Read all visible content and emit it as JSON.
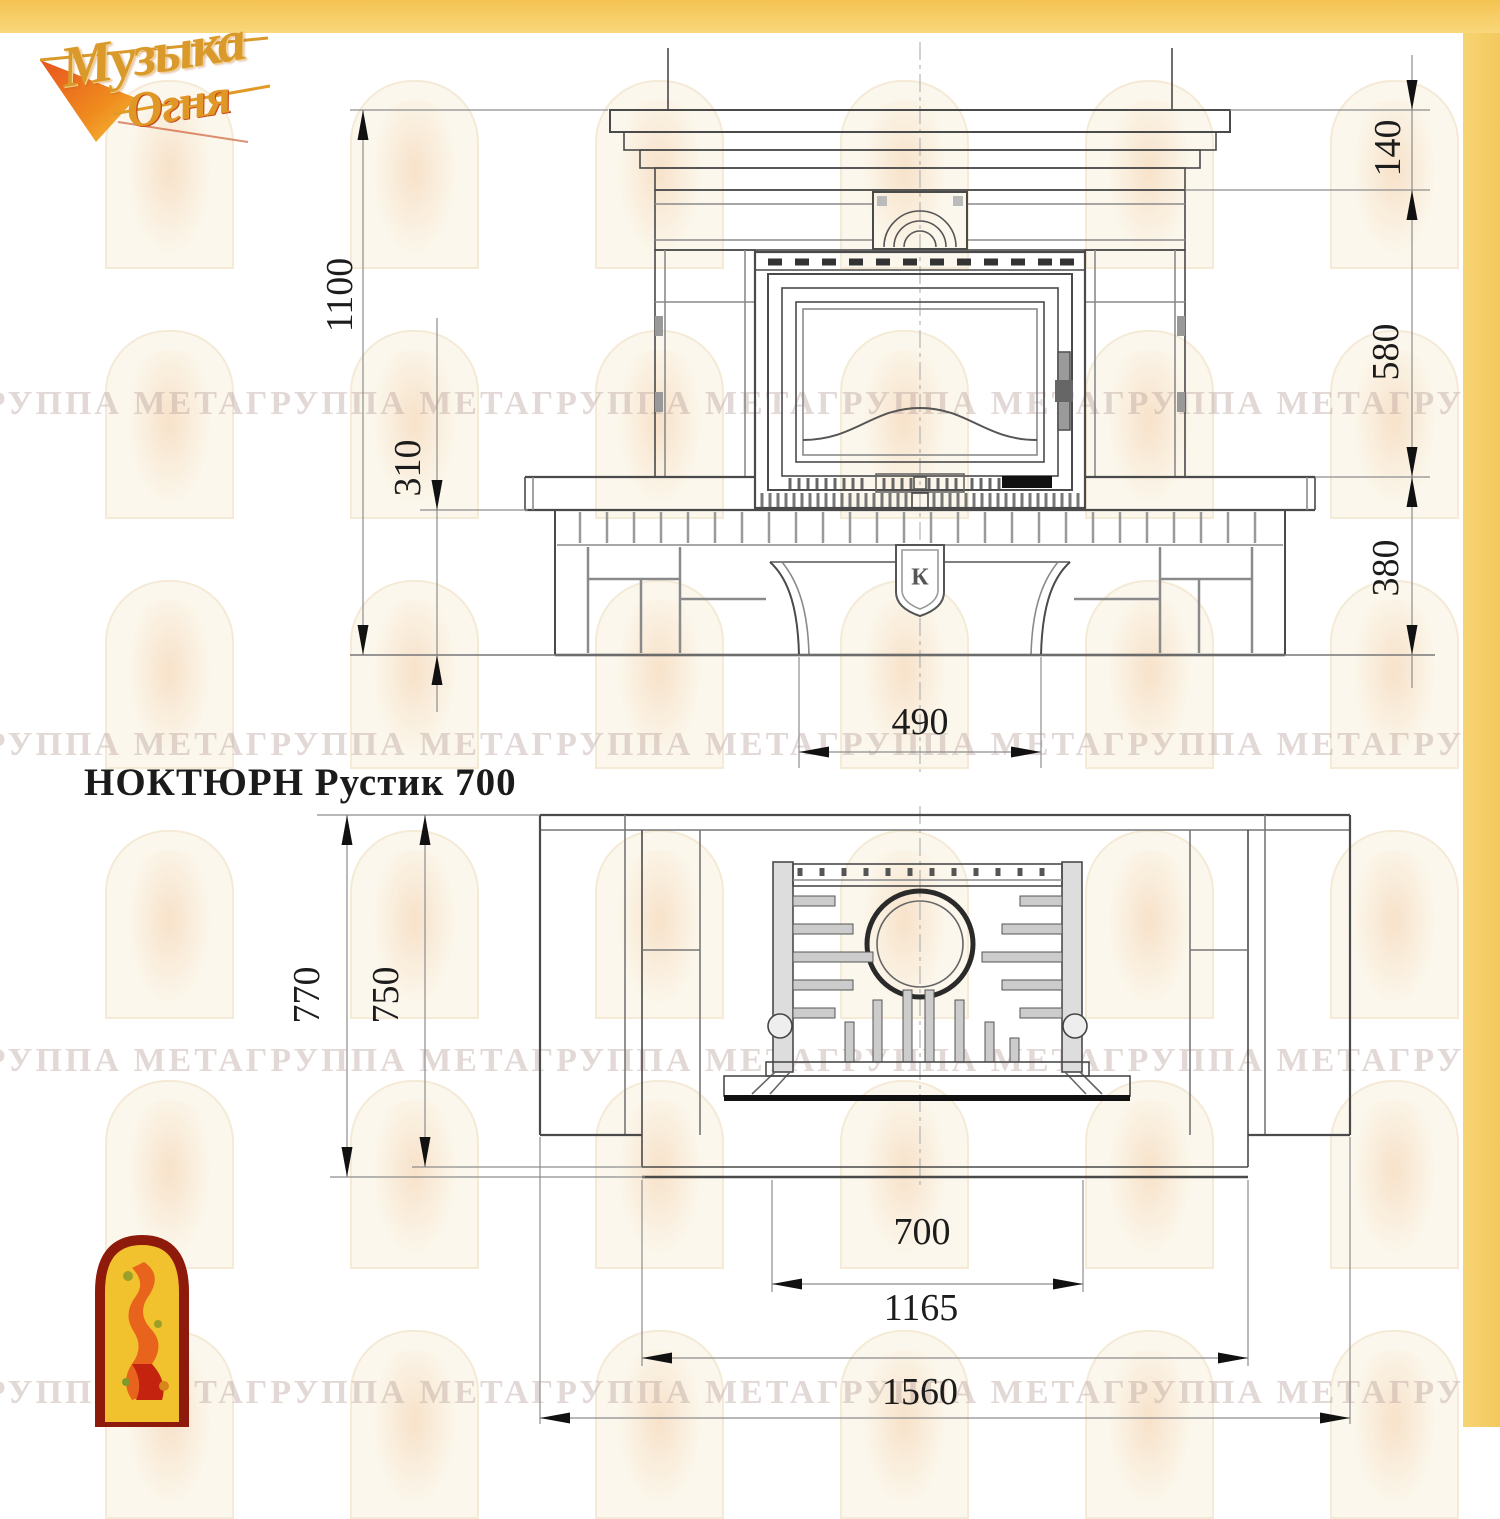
{
  "brand": {
    "word1": "Музыка",
    "word2": "Огня"
  },
  "title": "НОКТЮРН Рустик 700",
  "watermark": {
    "text": "ГРУППА МЕТАГРУППА МЕТАГРУППА МЕТАГРУППА МЕТАГРУППА МЕТАГРУППА МЕТА"
  },
  "colors": {
    "band_yellow": "#f6c95f",
    "logo_gold": "#d99a2b",
    "logo_red": "#c8371a",
    "arch_red": "#8e1a0c",
    "arch_yellow": "#f2c12e"
  },
  "front_view": {
    "dims": {
      "total_height": "1100",
      "plinth_height": "310",
      "shelf_height": "140",
      "firebox_zone_height": "580",
      "bench_height": "380",
      "portal_width": "490"
    },
    "shield_letter": "К"
  },
  "plan_view": {
    "dims": {
      "depth_total": "770",
      "depth_body": "750",
      "insert_width": "700",
      "bench_width": "1165",
      "total_width": "1560"
    }
  }
}
